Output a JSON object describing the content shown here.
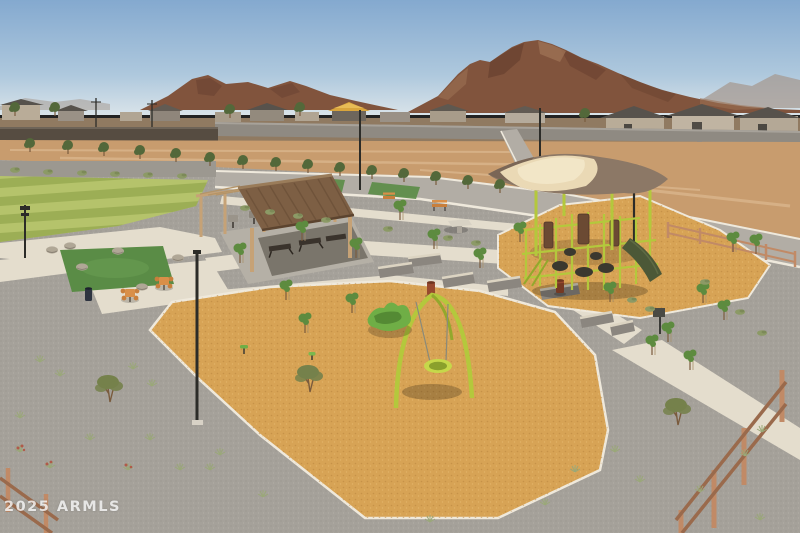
{
  "watermark": {
    "text": "2025 ARMLS"
  },
  "palette": {
    "sky_top": "#84a9cf",
    "sky_mid": "#aec8dd",
    "sky_horizon": "#d9e3e9",
    "haze": "#a59a92",
    "mountain": "#81543d",
    "mountain_dark": "#6a4130",
    "mountain_light": "#9c7154",
    "dirt": "#c89c6e",
    "dirt_light": "#dab68c",
    "wall_dark": "#564c41",
    "wall_gray": "#8f8a82",
    "wall_cap": "#a7a29a",
    "house_roof": "#57524c",
    "house_wall": "#b9ac98",
    "road": "#b2ada5",
    "curb": "#efe9dc",
    "gravel": "#a5a19a",
    "gravel_dark": "#8b877f",
    "gravel_light": "#c9c4ba",
    "path": "#e4ddcd",
    "pad": "#b5b0a6",
    "lawn_light": "#b5c36b",
    "lawn_dark": "#9cae55",
    "turf": "#5a8c46",
    "woodchip": "#d7a355",
    "chip_dark": "#b5803a",
    "chip_light": "#edc27c",
    "roof_brown": "#7d5f44",
    "roof_light": "#9a7c5a",
    "wood": "#c6a276",
    "sail_cream": "#ead9b5",
    "sail_taupe": "#8c7866",
    "lime": "#b4c83c",
    "lime_dark": "#93a82c",
    "slide": "#4c5837",
    "play_brown": "#6b4a33",
    "play_dark": "#3b382f",
    "seat_wall": "#8b867f",
    "seat_cap": "#dcd4c2",
    "rust": "#97492e",
    "can_dark": "#2d3340",
    "fence": "#c18a66",
    "fence_dark": "#9a6a4c",
    "tree": "#5d8b3f",
    "tree_dark": "#53683a",
    "olive": "#75814b",
    "shrub": "#8c9a66",
    "tuft": "#9aa878",
    "trunk": "#7a5b3d",
    "red_flower": "#b05a4a",
    "lamp": "#2c2c28"
  }
}
